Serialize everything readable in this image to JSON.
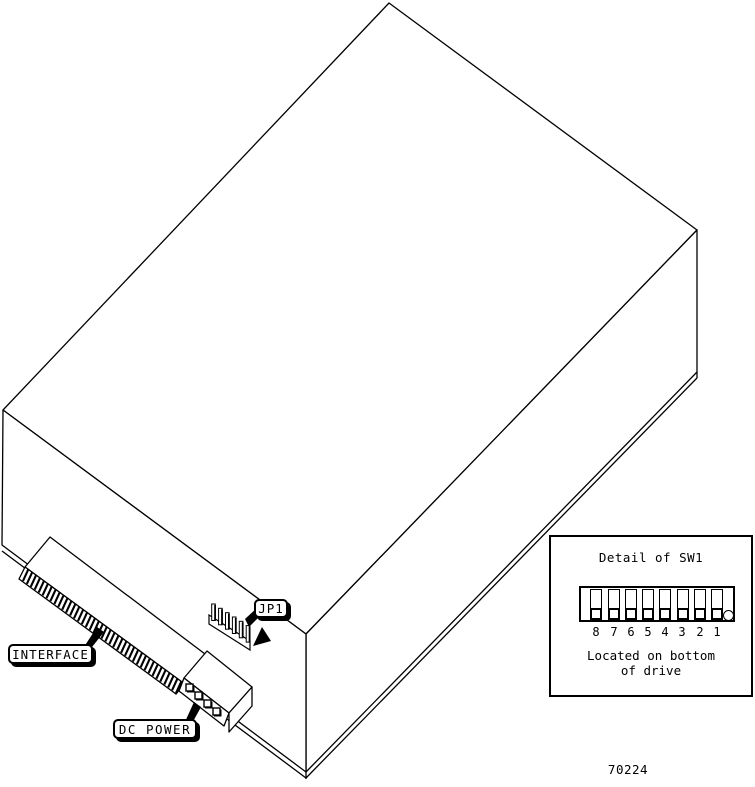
{
  "colors": {
    "ink": "#000000",
    "paper": "#ffffff"
  },
  "drawing": {
    "callouts": {
      "interface": "INTERFACE",
      "dc_power": "DC POWER",
      "jp1": "JP1"
    },
    "figure_number": "70224"
  },
  "detail_box": {
    "title": "Detail of SW1",
    "switch_numbers": [
      "8",
      "7",
      "6",
      "5",
      "4",
      "3",
      "2",
      "1"
    ],
    "note_line1": "Located on bottom",
    "note_line2": "of drive"
  }
}
